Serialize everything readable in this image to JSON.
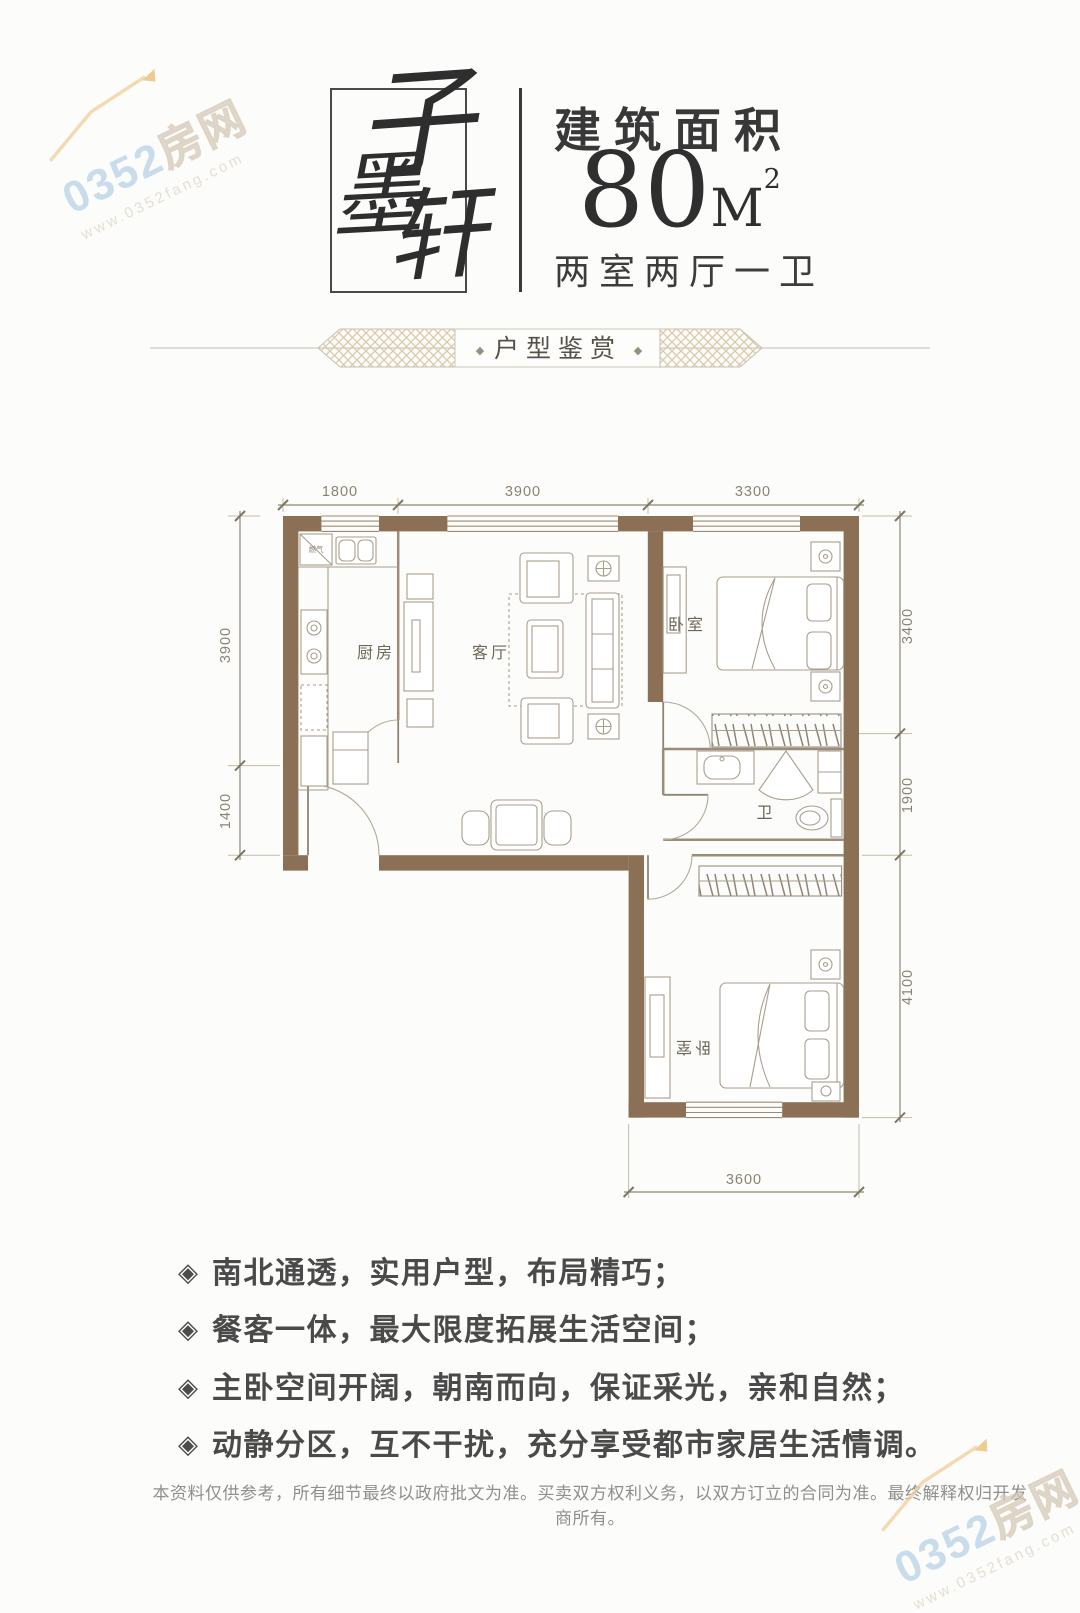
{
  "watermark": {
    "brand_number": "0352",
    "brand_suffix": "房网",
    "url": "www.0352fang.com"
  },
  "header": {
    "logo": {
      "name": "子墨轩",
      "char1": "子",
      "char2": "墨",
      "char3": "轩"
    },
    "area_label": "建筑面积",
    "area_value": "80",
    "area_unit": "M",
    "area_sup": "2",
    "layout_text": "两室两厅一卫"
  },
  "banner": {
    "title": "户型鉴赏",
    "dot_left": "◆",
    "dot_right": "◆"
  },
  "floorplan": {
    "dims": {
      "top": [
        "1800",
        "3900",
        "3300"
      ],
      "left": [
        "3900",
        "1400"
      ],
      "right": [
        "3400",
        "1900",
        "4100"
      ],
      "bottom": [
        "3600"
      ]
    },
    "rooms": {
      "kitchen": "厨房",
      "living": "客厅",
      "bedroom1": "卧室",
      "bath": "卫",
      "bedroom2": "卧室",
      "gas": "燃气"
    }
  },
  "features": {
    "icon": "◈",
    "items": [
      "南北通透，实用户型，布局精巧；",
      "餐客一体，最大限度拓展生活空间；",
      "主卧空间开阔，朝南而向，保证采光，亲和自然；",
      "动静分区，互不干扰，充分享受都市家居生活情调。"
    ]
  },
  "footer": {
    "disclaimer": "本资料仅供参考，所有细节最终以政府批文为准。买卖双方权利义务，以双方订立的合同为准。最终解释权归开发商所有。"
  }
}
